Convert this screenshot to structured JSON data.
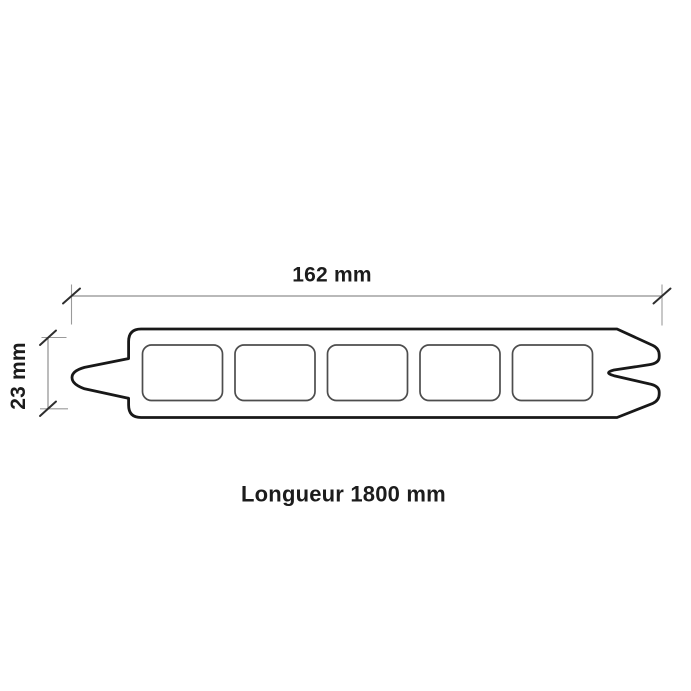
{
  "diagram": {
    "type": "decking-board-cross-section",
    "labels": {
      "width": "162 mm",
      "thickness": "23 mm",
      "length": "Longueur 1800 mm"
    },
    "dimensions": {
      "width_mm": 162,
      "thickness_mm": 23,
      "length_mm": 1800
    },
    "profile": {
      "hollow_chambers": 5,
      "left_feature": "tongue",
      "right_feature": "groove"
    },
    "colors": {
      "background": "#ffffff",
      "outline": "#181818",
      "chamber_stroke": "#4d4d4d",
      "dimension_line": "#8f8f8f",
      "tick": "#2e2e2e",
      "text": "#1c1c1c"
    }
  }
}
